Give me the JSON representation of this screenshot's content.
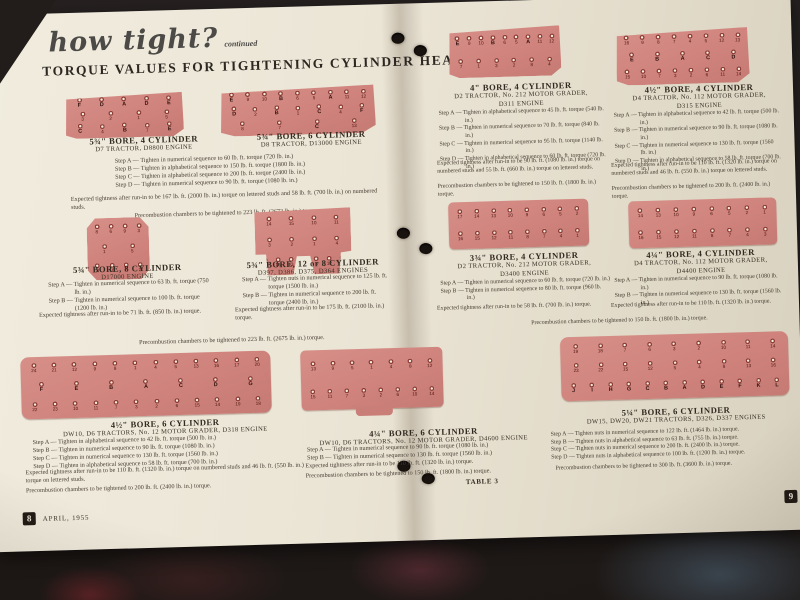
{
  "header": {
    "script_title": "how tight?",
    "script_continued": "continued",
    "main_title": "TORQUE VALUES FOR TIGHTENING CYLINDER HEADS"
  },
  "left_page": {
    "s1": {
      "title": "5¾\" BORE, 4 CYLINDER",
      "sub": "D7 TRACTOR, D8800 ENGINE"
    },
    "s2": {
      "title": "5¾\" BORE, 6 CYLINDER",
      "sub": "D8 TRACTOR, D13000 ENGINE"
    },
    "s12": {
      "steps": [
        "Step A — Tighten in numerical sequence to 60 lb. ft. torque (720 lb. in.)",
        "Step B — Tighten in alphabetical sequence to 150 lb. ft. torque (1800 lb. in.)",
        "Step C — Tighten in alphabetical sequence to 200 lb. ft. torque (2400 lb. in.)",
        "Step D — Tighten in numerical sequence to 90 lb. ft. torque (1080 lb. in.)"
      ],
      "expected": "Expected tightness after run-in to be 167 lb. ft. (2000 lb. in.) torque on lettered studs and 58 lb. ft. (700 lb. in.) on numbered studs.",
      "precombustion": "Precombustion chambers to be tightened to 223 lb. ft. (2673 lb. in.) torque."
    },
    "s3": {
      "title": "5¾\" BORE, 8 CYLINDER",
      "sub": "D17000 ENGINE",
      "steps": [
        "Step A — Tighten in numerical sequence to 63 lb. ft. torque (750 lb. in.)",
        "Step B — Tighten in numerical sequence to 100 lb. ft. torque (1200 lb. in.)"
      ],
      "expected": "Expected tightness after run-in to be 71 lb. ft. (850 lb. in.) torque."
    },
    "s4": {
      "title": "5¾\" BORE, 12 or 8 CYLINDER",
      "sub": "D397, D386, D375, D364 ENGINES",
      "steps": [
        "Step A — Tighten nuts in numerical sequence to 125 lb. ft. torque (1500 lb. in.)",
        "Step B — Tighten in numerical sequence to 200 lb. ft. torque (2400 lb. in.)"
      ],
      "expected": "Expected tightness after run-in to be 175 lb. ft. (2100 lb. in.) torque."
    },
    "s34_precombustion": "Precombustion chambers to be tightened to 223 lb. ft. (2675 lb. in.) torque.",
    "s5": {
      "title": "4½\" BORE, 6 CYLINDER",
      "sub": "DW10, D6 TRACTORS, No. 12 MOTOR GRADER, D318 ENGINE",
      "steps": [
        "Step A — Tighten in alphabetical sequence to 42 lb. ft. torque (500 lb. in.)",
        "Step B — Tighten in numerical sequence to 90 lb. ft. torque (1080 lb. in.)",
        "Step C — Tighten in numerical sequence to 130 lb. ft. torque (1560 lb. in.)",
        "Step D — Tighten in alphabetical sequence to 58 lb. ft. torque (700 lb. in.)"
      ],
      "expected": "Expected tightness after run-in to be 110 lb. ft. (1320 lb. in.) torque on numbered studs and 46 lb. ft. (550 lb. in.) torque on lettered studs.",
      "precombustion": "Precombustion chambers to be tightened to 200 lb. ft. (2400 lb. in.) torque."
    },
    "s6": {
      "title": "4¼\" BORE, 6 CYLINDER",
      "sub": "DW10, D6 TRACTORS, No. 12 MOTOR GRADER, D4600 ENGINE",
      "steps": [
        "Step A — Tighten in numerical sequence to 90 lb. ft. torque (1080 lb. in.)",
        "Step B — Tighten in numerical sequence to 130 lb. ft. torque (1560 lb. in.)"
      ],
      "expected": "Expected tightness after run-in to be 110 lb. ft. (1320 lb. in.) torque.",
      "precombustion": "Precombustion chambers to be tightened to 150 lb. ft. (1800 lb. in.) torque."
    },
    "footer": {
      "page_number": "8",
      "date": "APRIL, 1955"
    }
  },
  "right_page": {
    "s7": {
      "title": "4\" BORE, 4 CYLINDER",
      "sub": "D2 TRACTOR, No. 212 MOTOR GRADER,",
      "sub2": "D311 ENGINE",
      "steps": [
        "Step A — Tighten in alphabetical sequence to 45 lb. ft. torque (540 lb. in.)",
        "Step B — Tighten in numerical sequence to 70 lb. ft. torque (840 lb. in.)",
        "Step C — Tighten in numerical sequence to 95 lb. ft. torque (1140 lb. in.)",
        "Step D — Tighten in alphabetical sequence to 60 lb. ft. torque (720 lb. in.)"
      ],
      "expected": "Expected tightness after run-in to be 90 lb. ft. (1080 lb. in.) torque on numbered studs and 55 lb. ft. (660 lb. in.) torque on lettered studs.",
      "precombustion": "Precombustion chambers to be tightened to 150 lb. ft. (1800 lb. in.) torque."
    },
    "s8": {
      "title": "4½\" BORE, 4 CYLINDER",
      "sub": "D4 TRACTOR, No. 112 MOTOR GRADER,",
      "sub2": "D315 ENGINE",
      "steps": [
        "Step A — Tighten in alphabetical sequence to 42 lb. ft. torque (500 lb. in.)",
        "Step B — Tighten in numerical sequence to 90 lb. ft. torque (1080 lb. in.)",
        "Step C — Tighten in numerical sequence to 130 lb. ft. torque (1560 lb. in.)",
        "Step D — Tighten in alphabetical sequence to 58 lb. ft. torque (700 lb. in.)"
      ],
      "expected": "Expected tightness after run-in to be 110 lb. ft. (1320 lb. in.) torque on numbered studs and 46 lb. ft. (550 lb. in.) torque on lettered studs.",
      "precombustion": "Precombustion chambers to be tightened to 200 lb. ft. (2400 lb. in.) torque."
    },
    "s9": {
      "title": "3¾\" BORE, 4 CYLINDER",
      "sub": "D2 TRACTOR, No. 212 MOTOR GRADER,",
      "sub2": "D3400 ENGINE",
      "steps": [
        "Step A — Tighten in numerical sequence to 60 lb. ft. torque (720 lb. in.)",
        "Step B — Tighten in numerical sequence to 80 lb. ft. torque (960 lb. in.)"
      ],
      "expected": "Expected tightness after run-in to be 58 lb. ft. (700 lb. in.) torque."
    },
    "s10": {
      "title": "4¼\" BORE, 4 CYLINDER",
      "sub": "D4 TRACTOR, No. 112 MOTOR GRADER,",
      "sub2": "D4400 ENGINE",
      "steps": [
        "Step A — Tighten in numerical sequence to 90 lb. ft. torque (1080 lb. in.)",
        "Step B — Tighten in numerical sequence to 130 lb. ft. torque (1560 lb. in.)"
      ],
      "expected": "Expected tightness after run-in to be 110 lb. ft. (1320 lb. in.) torque."
    },
    "s910_precombustion": "Precombustion chambers to be tightened to 150 lb. ft. (1800 lb. in.) torque.",
    "s11": {
      "title": "5¼\" BORE, 6 CYLINDER",
      "sub": "DW15, DW20, DW21 TRACTORS, D326, D337 ENGINES",
      "steps": [
        "Step A — Tighten nuts in numerical sequence to 122 lb. ft. (1464 lb. in.) torque.",
        "Step B — Tighten nuts in alphabetical sequence to 63 lb. ft. (755 lb. in.) torque.",
        "Step C — Tighten nuts in numerical sequence to 200 lb. ft. (2400 lb. in.) torque.",
        "Step D — Tighten nuts in alphabetical sequence to 100 lb. ft. (1200 lb. in.) torque."
      ],
      "precombustion": "Precombustion chambers to be tightened to 300 lb. ft. (3600 lb. in.) torque."
    },
    "footer": {
      "table_label": "TABLE 3",
      "page_number": "9"
    }
  },
  "diagrams": {
    "d1": {
      "shape": "trap",
      "rows": [
        [
          "F",
          "D",
          "A",
          "D",
          "E"
        ],
        [
          "3",
          "2",
          "1",
          "5"
        ],
        [
          "C",
          "4",
          "B",
          "7",
          "E"
        ]
      ]
    },
    "d2": {
      "shape": "trap",
      "rows": [
        [
          "E",
          "9",
          "10",
          "B",
          "6",
          "5",
          "A",
          "11",
          "12"
        ],
        [
          "D",
          "2",
          "B",
          "1",
          "C",
          "4",
          "F"
        ],
        [
          "8",
          "7",
          "C",
          "13"
        ]
      ]
    },
    "d3": {
      "shape": "oct",
      "rows": [
        [
          "8",
          "6",
          "9",
          "3"
        ],
        [
          "1",
          "5"
        ],
        [
          "4",
          "10",
          "7",
          "2"
        ]
      ]
    },
    "d4": {
      "shape": "scallop",
      "rows": [
        [
          "14",
          "15",
          "10",
          "11"
        ],
        [
          "3",
          "2",
          "1",
          "4"
        ],
        [
          "7",
          "16",
          "13",
          "6",
          "5",
          "12",
          "8"
        ]
      ]
    },
    "d5": {
      "shape": "rect",
      "rows": [
        [
          "24",
          "21",
          "12",
          "9",
          "8",
          "1",
          "4",
          "5",
          "13",
          "16",
          "17",
          "20"
        ],
        [
          "F",
          "E",
          "B",
          "A",
          "C",
          "D",
          "G"
        ],
        [
          "22",
          "23",
          "10",
          "11",
          "7",
          "3",
          "2",
          "6",
          "15",
          "14",
          "19",
          "18"
        ]
      ]
    },
    "d6": {
      "shape": "tab",
      "rows": [
        [
          "13",
          "9",
          "5",
          "1",
          "4",
          "8",
          "12"
        ],
        [
          "15",
          "11",
          "7",
          "3",
          "2",
          "6",
          "10",
          "14"
        ]
      ]
    },
    "d7": {
      "shape": "trap",
      "rows": [
        [
          "E",
          "9",
          "10",
          "B",
          "6",
          "5",
          "A",
          "11",
          "12"
        ],
        [
          "7",
          "1",
          "3",
          "2",
          "8",
          "4"
        ]
      ]
    },
    "d8": {
      "shape": "trap",
      "rows": [
        [
          "16",
          "9",
          "8",
          "7",
          "4",
          "5",
          "12",
          "13"
        ],
        [
          "E",
          "B",
          "A",
          "C",
          "D"
        ],
        [
          "15",
          "10",
          "7",
          "3",
          "2",
          "6",
          "11",
          "14"
        ]
      ]
    },
    "d9": {
      "shape": "rect",
      "rows": [
        [
          "17",
          "14",
          "13",
          "10",
          "9",
          "6",
          "5",
          "2"
        ],
        [
          "16",
          "15",
          "12",
          "11",
          "8",
          "7",
          "4",
          "1"
        ]
      ]
    },
    "d10": {
      "shape": "rect",
      "rows": [
        [
          "14",
          "13",
          "10",
          "9",
          "6",
          "5",
          "2",
          "1"
        ],
        [
          "16",
          "15",
          "12",
          "11",
          "8",
          "7",
          "4",
          "3"
        ]
      ]
    },
    "d11": {
      "shape": "rect",
      "rows": [
        [
          "19",
          "18",
          "7",
          "6",
          "3",
          "2",
          "10",
          "11",
          "14"
        ],
        [
          "23",
          "22",
          "15",
          "12",
          "5",
          "4",
          "8",
          "13",
          "16"
        ],
        [
          "J",
          "I",
          "H",
          "G",
          "C",
          "B",
          "A",
          "D",
          "E",
          "F",
          "K",
          "L"
        ]
      ]
    }
  },
  "colors": {
    "paper": "#ebe5d6",
    "diagram_pink": "#d0837d",
    "bolt_ring": "#8c3a32",
    "fabric_maroon": "#4d282d",
    "fabric_blue": "#3e4a55",
    "background": "#1e1917"
  }
}
